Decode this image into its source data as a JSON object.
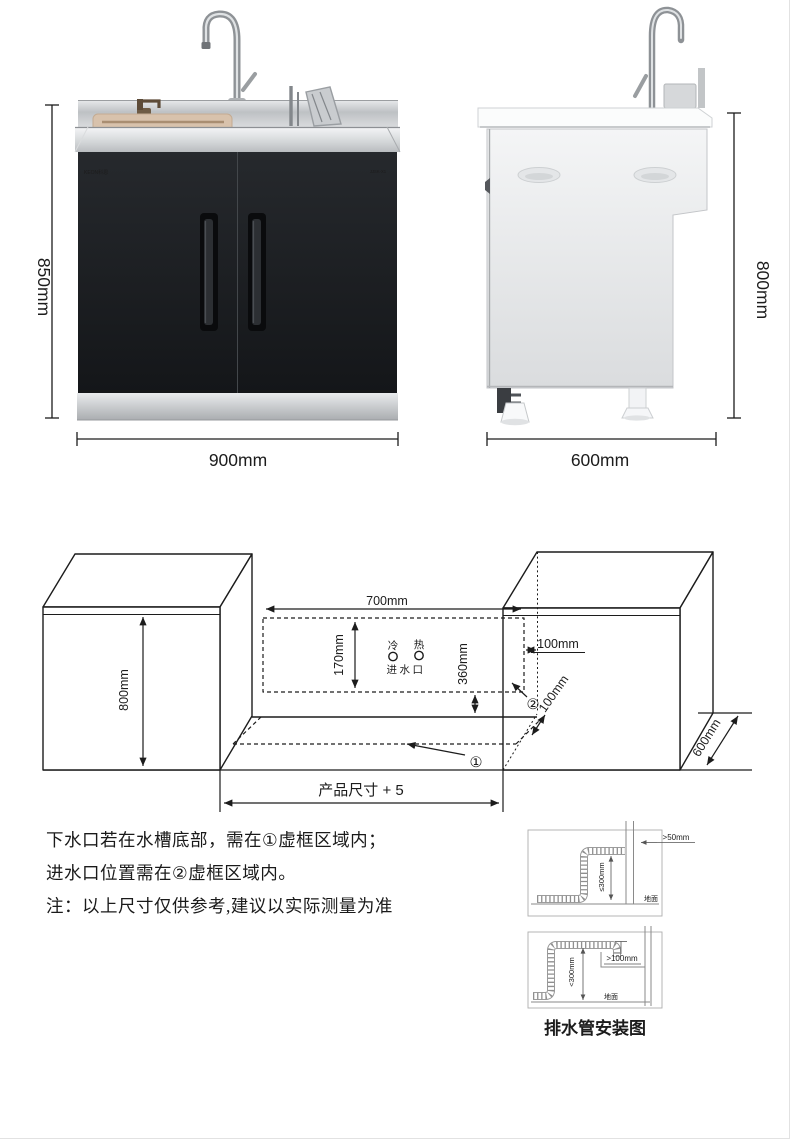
{
  "front_view": {
    "height": "850mm",
    "width": "900mm",
    "brand": "KEON科恩",
    "model": "JJSK-X1"
  },
  "side_view": {
    "height": "800mm",
    "depth": "600mm"
  },
  "install": {
    "cabinet_height": "800mm",
    "top_width": "700mm",
    "inlet_zone_height": "170mm",
    "inlet_drop": "360mm",
    "side_gap": "100mm",
    "front_gap": "100mm",
    "depth": "600mm",
    "cutout": "产品尺寸 + 5",
    "cold": "冷",
    "hot": "热",
    "inlet": "进水口",
    "zone1": "①",
    "zone2": "②"
  },
  "notes": {
    "line1": "下水口若在水槽底部，需在①虚框区域内；",
    "line2": "进水口位置需在②虚框区域内。",
    "line3": "注：以上尺寸仅供参考,建议以实际测量为准"
  },
  "drain": {
    "caption": "排水管安装图",
    "top_clearance": ">50mm",
    "top_height": "≤300mm",
    "top_ground": "地面",
    "bottom_clearance": ">100mm",
    "bottom_height": "<300mm",
    "bottom_ground": "地面"
  }
}
